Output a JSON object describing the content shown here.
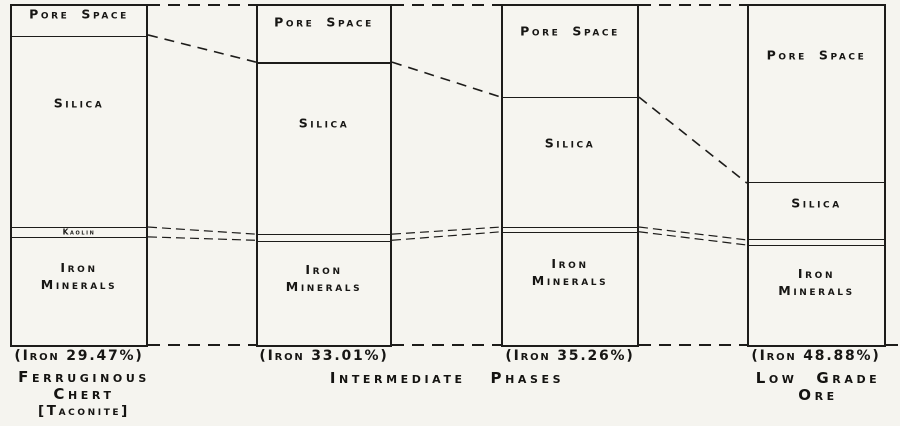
{
  "colors": {
    "paper": "#f5f4ef",
    "ink": "#1d1c1a"
  },
  "chart_data": {
    "type": "bar",
    "subtype": "100-percent-stacked-composition-columns",
    "title": "",
    "xlabel": "",
    "ylabel": "",
    "legend": "none",
    "unit": "fraction of column height (composition)",
    "categories": [
      "Ferruginous Chert [Taconite]",
      "Intermediate Phase (Iron 33.01%)",
      "Intermediate Phase (Iron 35.26%)",
      "Low Grade Ore"
    ],
    "columns": [
      {
        "name": "ferruginous-chert",
        "iron_caption": "(Iron 29.47%)",
        "iron_pct": 29.47,
        "segments": [
          {
            "label": "Pore Space",
            "pct": 8.8
          },
          {
            "label": "Silica",
            "pct": 56.5
          },
          {
            "label": "Kaolin",
            "pct": 2.9
          },
          {
            "label": "Iron Minerals",
            "pct": 31.8
          }
        ]
      },
      {
        "name": "intermediate-phase-1",
        "iron_caption": "(Iron 33.01%)",
        "iron_pct": 33.01,
        "segments": [
          {
            "label": "Pore Space",
            "pct": 16.8
          },
          {
            "label": "Silica",
            "pct": 50.6
          },
          {
            "label": "",
            "pct": 1.8
          },
          {
            "label": "Iron Minerals",
            "pct": 30.8
          }
        ]
      },
      {
        "name": "intermediate-phase-2",
        "iron_caption": "(Iron 35.26%)",
        "iron_pct": 35.26,
        "segments": [
          {
            "label": "Pore Space",
            "pct": 27.1
          },
          {
            "label": "Silica",
            "pct": 38.2
          },
          {
            "label": "",
            "pct": 1.4
          },
          {
            "label": "Iron Minerals",
            "pct": 33.3
          }
        ]
      },
      {
        "name": "low-grade-ore",
        "iron_caption": "(Iron 48.88%)",
        "iron_pct": 48.88,
        "segments": [
          {
            "label": "Pore Space",
            "pct": 52.4
          },
          {
            "label": "Silica",
            "pct": 16.7
          },
          {
            "label": "",
            "pct": 1.5
          },
          {
            "label": "Iron Minerals",
            "pct": 29.4
          }
        ]
      }
    ],
    "group_labels": [
      {
        "lines": [
          "Ferruginous",
          "Chert",
          "[Taconite]"
        ]
      },
      {
        "lines": [
          "Intermediate Phases"
        ]
      },
      {
        "lines": [
          "Low Grade",
          "Ore"
        ]
      }
    ]
  }
}
